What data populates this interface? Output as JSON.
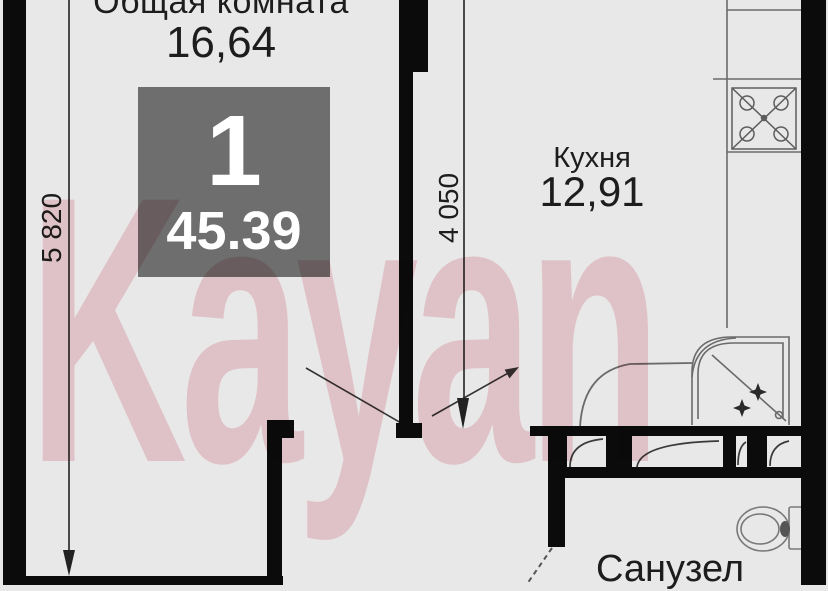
{
  "watermark": {
    "text": "Kayan",
    "color": "#f4d6dc"
  },
  "badge": {
    "rooms_count": "1",
    "total_area": "45.39",
    "bg_color": "#6e6e6e"
  },
  "rooms": {
    "living": {
      "label": "Общая комната",
      "area": "16,64"
    },
    "kitchen": {
      "label": "Кухня",
      "area": "12,91"
    },
    "bathroom": {
      "label": "Санузел"
    }
  },
  "dimensions": {
    "left_height": "5 820",
    "middle_height": "4 050"
  },
  "colors": {
    "background": "#e9e8e8",
    "wall": "#0b0b0b",
    "fixture_line": "#6a6a6a",
    "text": "#1d1d1d",
    "watermark_pink": "#f4d6dc",
    "badge_gray": "#6e6e6e"
  },
  "icons": [
    "stove-icon",
    "shower-icon",
    "toilet-icon",
    "entry-arrow-icon",
    "dimension-arrow-icon"
  ]
}
